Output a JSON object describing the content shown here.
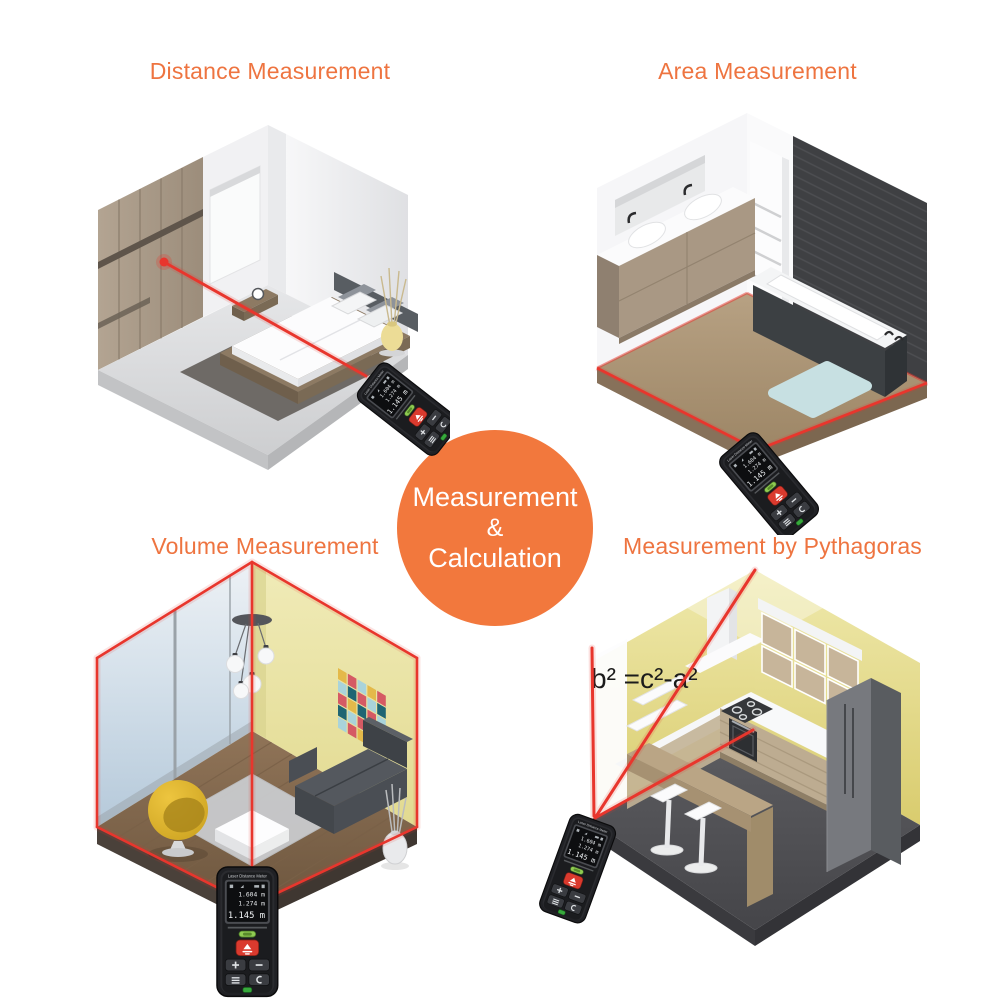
{
  "badge": {
    "line1": "Measurement",
    "line2": "&",
    "line3": "Calculation"
  },
  "sections": {
    "distance": {
      "title": "Distance Measurement"
    },
    "area": {
      "title": "Area Measurement"
    },
    "volume": {
      "title": "Volume Measurement"
    },
    "pythagoras": {
      "title": "Measurement by Pythagoras",
      "formula": "b² =c²-a²"
    }
  },
  "device": {
    "brand": "Laser Distance Meter",
    "display": {
      "line1": "1.604 m",
      "line2": "1.274 m",
      "line3": "1.145 m"
    }
  },
  "colors": {
    "accent_orange": "#f2783d",
    "laser_red": "#e8362d"
  }
}
